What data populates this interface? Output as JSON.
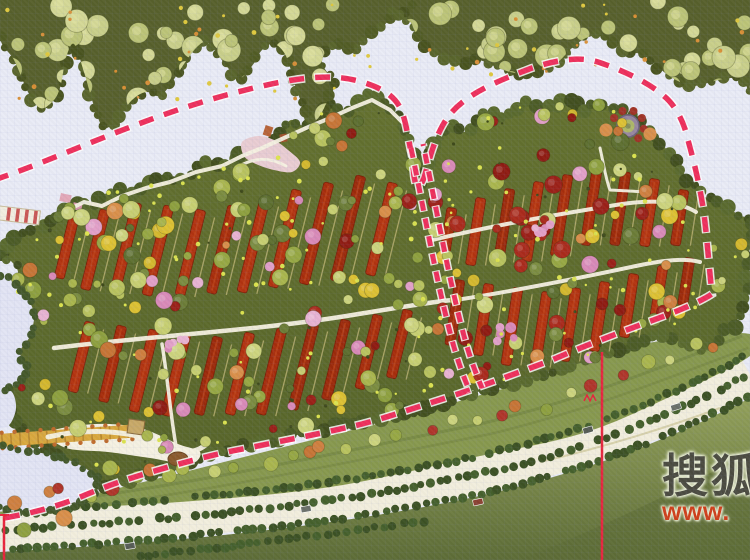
{
  "watermark": {
    "brand_text": "搜狐",
    "url_text": "www."
  },
  "scene": {
    "type": "residential-master-plan",
    "features": [
      "site-boundary-dashed-line",
      "phase-divider-dashed-line",
      "forest-belt",
      "row-houses-red-roof",
      "lake-with-boardwalk",
      "tree-lined-boulevard",
      "entrance-roundabout",
      "section-leader-lines",
      "sohu-watermark"
    ]
  },
  "palette": {
    "background": "#e9ebf6",
    "forest_base": "#57602c",
    "forest_canopies": [
      "#c9cf8a",
      "#d4d896",
      "#bcc478"
    ],
    "top_strip_tan": "#b2aa66",
    "top_edge_rust": "#9a4f28",
    "site_base_a": "#64712f",
    "site_base_b": "#57652a",
    "site_edge_greens": [
      "#4c5c26",
      "#5a6a2e",
      "#424f1f"
    ],
    "roof_reds": [
      "#a72d0c",
      "#9c2a0b",
      "#b23310"
    ],
    "roof_stroke": "#7c1f07",
    "roof_ridge": "#c24a1e",
    "trunk_tan": "#c3b878",
    "path_white": "#f5f1e2",
    "tree_greens": [
      "#b9c35f",
      "#c7cf72",
      "#aab64e",
      "#cdd47e",
      "#97a844",
      "#8ea03f"
    ],
    "tree_dark_greens": [
      "#5e6f30",
      "#6c7d38",
      "#7b8c40"
    ],
    "tree_reds": [
      "#9b2018",
      "#8f1b12",
      "#aa2a1c"
    ],
    "tree_oranges": [
      "#cf8040",
      "#d98f4a",
      "#c77536"
    ],
    "tree_yellows": [
      "#ddc133",
      "#d4b82e"
    ],
    "tree_pinks": [
      "#e2a0c8",
      "#d98ab8",
      "#e8b3d2"
    ],
    "shrub_dot": "#dce34f",
    "dark_dot": "#3f4a1c",
    "lake": "#e2e4f4",
    "shore_bush": "#44582a",
    "boardwalk": "#d9a83e",
    "boardwalk_dark": "#b9882e",
    "boardwalk_post": "#bf6b2c",
    "road": "#f2eedd",
    "road_median": "#cfc99f",
    "verge": "#87984e",
    "verge_streak": "#6c7d3c",
    "hedge": [
      "#3c5124",
      "#45602c"
    ],
    "field_light": "#93a15b",
    "field_dark": "#5d6c37",
    "boundary_pink": "#ee2f5c",
    "boundary_halo": "#ffffff",
    "leader_red": "#e8243c",
    "roundabout_outer": "#97879f",
    "roundabout_rim": "#6f6080",
    "roundabout_inner": "#aeb868",
    "plaza_pink": "#e9cdd3",
    "plaza_structure": "#b86438",
    "hut_tan": "#c8a968",
    "hut_stroke": "#8a6a3a",
    "mound_brown": "#8a5a2c",
    "pier_white": "#f2eee0",
    "pier_stripe": "#c33b3b",
    "car_colors": [
      "#565c53",
      "#6b7069",
      "#8a4030"
    ],
    "watermark_text": "#4b4b41",
    "watermark_url": "#cf3f1a"
  },
  "density": {
    "forest_canopies_left": 58,
    "forest_canopies_right": 46,
    "forest_dots": 60,
    "site_trees": 255,
    "site_bright_dots": 130,
    "site_dark_dots": 45,
    "verge_trees": 28
  }
}
